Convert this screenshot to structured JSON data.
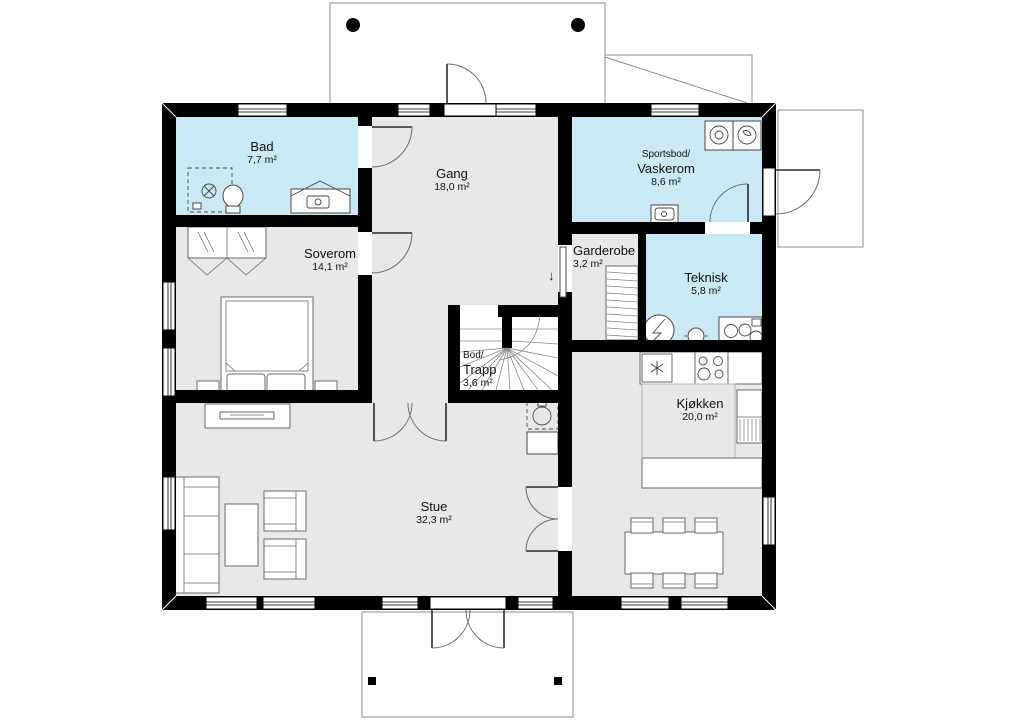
{
  "plan": {
    "rooms": [
      {
        "name": "Bad",
        "area": "7,7 m²"
      },
      {
        "name": "Gang",
        "area": "18,0 m²"
      },
      {
        "name_prefix": "Sportsbod/",
        "name": "Vaskerom",
        "area": "8,6 m²"
      },
      {
        "name": "Soverom",
        "area": "14,1 m²"
      },
      {
        "name": "Garderobe",
        "area": "3,2 m²"
      },
      {
        "name": "Teknisk",
        "area": "5,8 m²"
      },
      {
        "name_prefix": "Bod/",
        "name": "Trapp",
        "area": "3,6 m²"
      },
      {
        "name": "Kjøkken",
        "area": "20,0 m²"
      },
      {
        "name": "Stue",
        "area": "32,3 m²"
      }
    ],
    "symbols": {
      "stairs_down_arrow": "↓"
    },
    "colors": {
      "wet_room_fill": "#cbe9f4",
      "floor_fill": "#e8e8e8",
      "stair_fill": "#ffffff",
      "wall": "#000000"
    }
  }
}
